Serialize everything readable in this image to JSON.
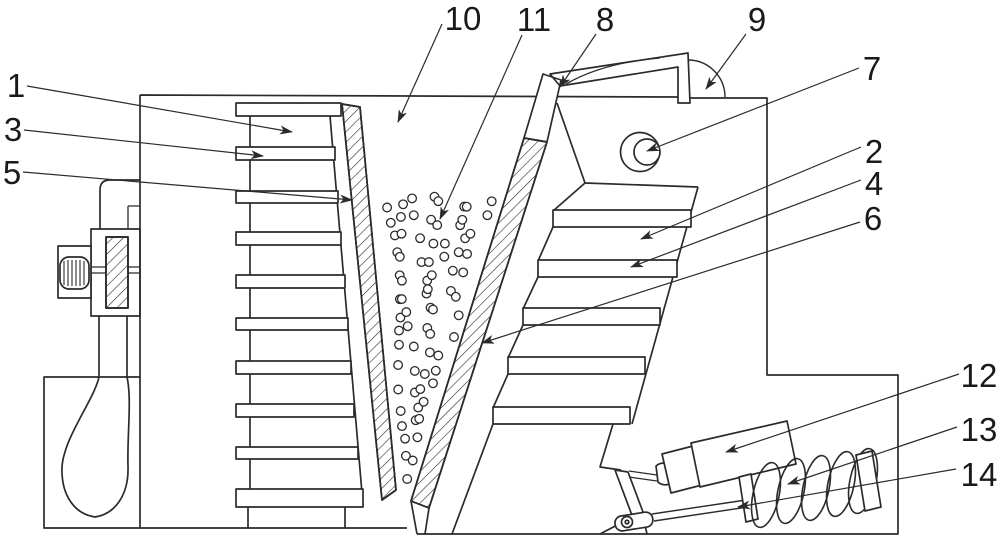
{
  "figure": {
    "figure_type": "patent-technical-line-drawing",
    "background": "#ffffff",
    "line_color": "#2b2b2b",
    "text_color": "#1a1a1a",
    "callouts": [
      {
        "ref": "1",
        "x": 16,
        "y": 97,
        "leader": [
          27,
          86,
          292,
          132
        ]
      },
      {
        "ref": "3",
        "x": 13,
        "y": 141,
        "leader": [
          24,
          130,
          263,
          156
        ]
      },
      {
        "ref": "5",
        "x": 12,
        "y": 184,
        "leader": [
          23,
          172,
          352,
          200
        ]
      },
      {
        "ref": "10",
        "x": 463,
        "y": 30,
        "leader": [
          442,
          24,
          398,
          122
        ]
      },
      {
        "ref": "11",
        "x": 534,
        "y": 31,
        "leader": [
          522,
          35,
          440,
          219
        ]
      },
      {
        "ref": "8",
        "x": 605,
        "y": 31,
        "leader": [
          596,
          34,
          560,
          87
        ]
      },
      {
        "ref": "9",
        "x": 757,
        "y": 31,
        "leader": [
          746,
          34,
          706,
          89
        ]
      },
      {
        "ref": "7",
        "x": 872,
        "y": 80,
        "leader": [
          859,
          68,
          647,
          151
        ]
      },
      {
        "ref": "2",
        "x": 874,
        "y": 163,
        "leader": [
          861,
          147,
          641,
          239
        ]
      },
      {
        "ref": "4",
        "x": 874,
        "y": 195,
        "leader": [
          861,
          180,
          631,
          267
        ]
      },
      {
        "ref": "6",
        "x": 873,
        "y": 230,
        "leader": [
          860,
          222,
          482,
          343
        ]
      },
      {
        "ref": "12",
        "x": 979,
        "y": 387,
        "leader": [
          959,
          374,
          726,
          452
        ]
      },
      {
        "ref": "13",
        "x": 979,
        "y": 441,
        "leader": [
          957,
          427,
          788,
          484
        ]
      },
      {
        "ref": "14",
        "x": 979,
        "y": 486,
        "leader": [
          956,
          469,
          738,
          507
        ]
      }
    ],
    "granules": {
      "y_start": 202,
      "y_end": 500,
      "row_step": 18.5,
      "radius": 4.3,
      "spacing": 16,
      "left_edge": {
        "x": 362,
        "y": 103,
        "slope": 0.0907,
        "inset": 9
      },
      "right_edge": {
        "x": 540,
        "y": 80,
        "slope": -0.305,
        "inset": 9
      }
    }
  }
}
